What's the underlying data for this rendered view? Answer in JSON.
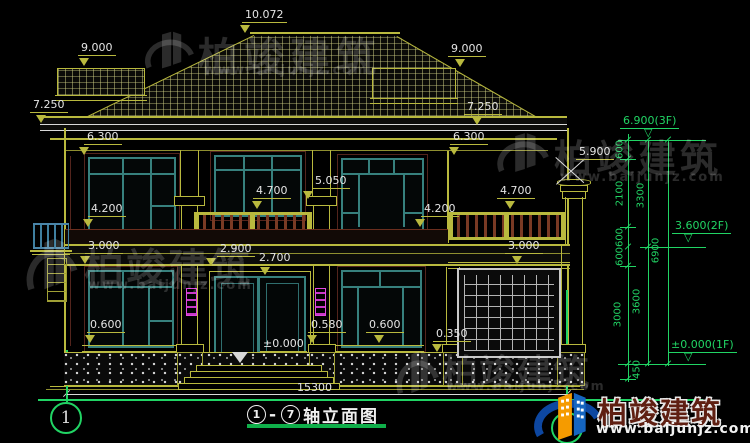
{
  "watermark": {
    "brand": "柏竣建筑",
    "url": "www.baijunjz.com"
  },
  "title": {
    "axis_from": "1",
    "dash": "-",
    "axis_to": "7",
    "name": "轴立面图",
    "full": "①-⑦轴立面图"
  },
  "axis_bubbles": {
    "left": "1",
    "right": "7"
  },
  "marks": {
    "m10072": "10.072",
    "m9000l": "9.000",
    "m9000r": "9.000",
    "m7250l": "7.250",
    "m7250r": "7.250",
    "m6300l": "6.300",
    "m6300r": "6.300",
    "m5900": "5.900",
    "m5050": "5.050",
    "m4700c": "4.700",
    "m4700r": "4.700",
    "m4200l": "4.200",
    "m4200r": "4.200",
    "m3000l": "3.000",
    "m3000r": "3.000",
    "m2900": "2.900",
    "m2700": "2.700",
    "m0600l": "0.600",
    "m0580": "0.580",
    "m0600m": "0.600",
    "m0350": "0.350",
    "m0000": "±0.000",
    "total": "15300"
  },
  "levels": {
    "f3": "6.900(3F)",
    "f2": "3.600(2F)",
    "f1": "±0.000(1F)",
    "s600a": "600",
    "s2100": "2100",
    "s600b": "600",
    "s600c": "600",
    "s3000": "3000",
    "s450": "450",
    "s3300": "3300",
    "s3600": "3600",
    "s6900": "6900"
  },
  "colors": {
    "cad_yellow": "#b9b93e",
    "cad_green": "#21d464",
    "window_teal": "#37807d",
    "rail_maroon": "#7a3a24",
    "lamp_magenta": "#e048e0",
    "brand_blue": "#1565c0",
    "brand_orange": "#f59b00",
    "dim_white": "#e4e4e4"
  }
}
